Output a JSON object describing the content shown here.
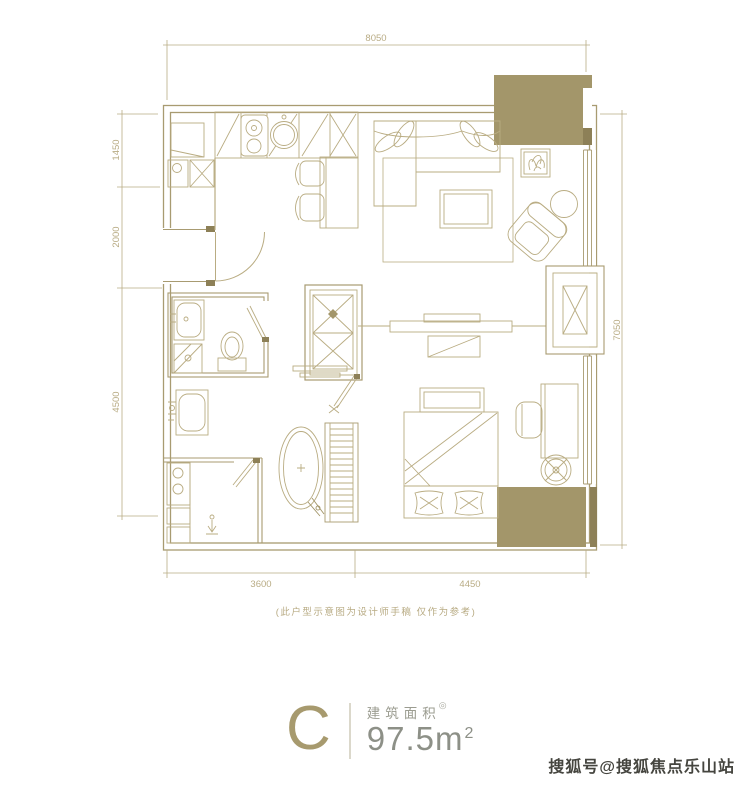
{
  "colors": {
    "wall_line": "#a89b71",
    "furniture_line": "#b9ac82",
    "gold_fill": "#a3966a",
    "gold_dark": "#8d8057",
    "dimension_text": "#b9ac85",
    "area_value_text": "#8d9087",
    "area_label_text": "#9b9c90",
    "watermark_text": "#45453f"
  },
  "floor_plan": {
    "dimensions": {
      "top": "8050",
      "left_top": "1450",
      "left_middle": "2000",
      "left_bottom": "4500",
      "right": "7050",
      "bottom_left": "3600",
      "bottom_right": "4450"
    },
    "disclaimer": "(此户型示意图为设计师手稿 仅作为参考)"
  },
  "unit_info": {
    "name": "C",
    "area_label": "建筑面积",
    "area_note": "◎",
    "area_value": "97.5m",
    "area_superscript": "2"
  },
  "watermark": "搜狐号@搜狐焦点乐山站"
}
